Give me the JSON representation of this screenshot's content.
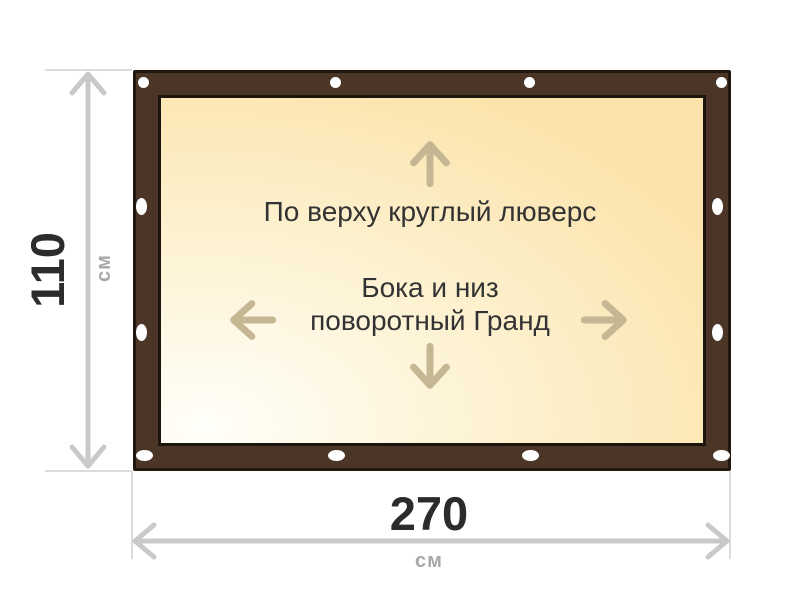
{
  "diagram": {
    "type": "product-dimension-diagram",
    "banner": {
      "top_edge_label": "По верху круглый люверс",
      "sides_bottom_label_line1": "Бока и низ",
      "sides_bottom_label_line2": "поворотный Гранд",
      "grommet_counts": {
        "top": 4,
        "bottom": 4,
        "left": 2,
        "right": 2
      }
    },
    "dimensions": {
      "height": {
        "value": "110",
        "unit": "см"
      },
      "width": {
        "value": "270",
        "unit": "см"
      }
    },
    "colors": {
      "frame": "#4a3527",
      "frame_outline": "#20170f",
      "canvas_light": "#fffef9",
      "canvas_dark": "#fbe3ab",
      "grommet": "#ffffff",
      "direction_arrow": "#c6b794",
      "dimension_line": "#c9c9c9",
      "value_text": "#2c2c2c",
      "unit_text": "#a8a8a8",
      "label_text": "#333333"
    }
  }
}
